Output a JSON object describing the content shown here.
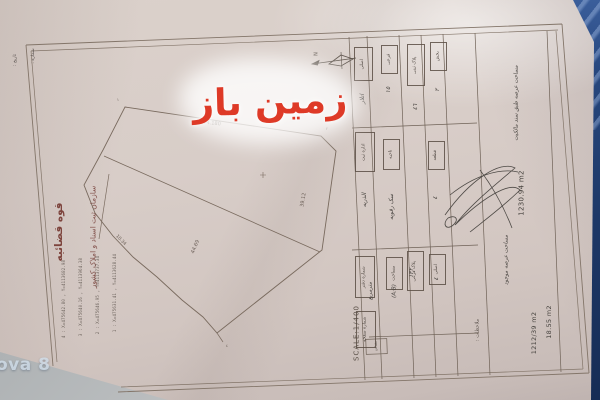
{
  "watermarks": {
    "site": "زمین باز",
    "camera": "ova 8"
  },
  "letterhead": {
    "line1": "قوه قضائیه",
    "line2": "سازمان ثبت اسناد و املاک کشور",
    "number_label": "شماره :",
    "date_label": "تاریخ :"
  },
  "compass": {
    "north": "N"
  },
  "coordinates": {
    "rows": [
      "4 : X=475642.80 , Y=4113682.98",
      "3 : X=475640.16 , Y=4113964.38",
      "2 : X=475646.95 , Y=4113737.34",
      "1 : X=475631.41 , Y=4113628.44"
    ]
  },
  "drawing": {
    "dims": [
      "74.180",
      "44.69",
      "39.12",
      "10.34"
    ],
    "vertex_marks": {
      "v1": "١",
      "v2": "٢",
      "v4": "٤"
    }
  },
  "table": {
    "row1": [
      {
        "label": "اصلی",
        "value": "اتلار"
      },
      {
        "label": "فرعی",
        "value": "١٥"
      },
      {
        "label": "پلاک ثبتی",
        "value": "٤٦"
      },
      {
        "label": "بخش",
        "value": "٢"
      }
    ],
    "row2": [
      {
        "label": "اداره ثبت",
        "value": "الذریه"
      },
      {
        "label": "ناحیه",
        "value": "سک رقویه"
      },
      {
        "label": "قطعه",
        "value": "٤"
      }
    ],
    "row3": [
      {
        "label": "شماره دفتر",
        "value": "مترمربع"
      },
      {
        "label": "مساحت",
        "value": "(A:B)"
      },
      {
        "label": "پلاک فرعی",
        "value": "١٣٢"
      },
      {
        "label": "اصلی",
        "value": "٤"
      }
    ],
    "row4": [
      {
        "label": "شماره صفحه",
        "value": ""
      }
    ],
    "scale_box_label": "مقیاس",
    "scale_text": "SCALE:1/400",
    "remarks_label": "ملاحظات :",
    "areas": {
      "note1": "مساحت عرصه طبق سند مالکیت",
      "value1": "1230.94 m2",
      "note2": "مساحت عرصه موجود",
      "value2": "18.55 m2",
      "value3": "1212/39 m2"
    }
  }
}
